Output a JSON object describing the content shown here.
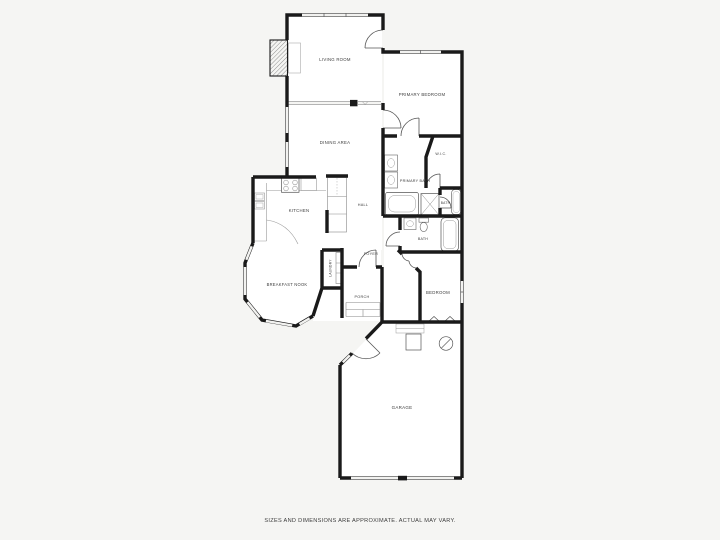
{
  "page": {
    "background_color": "#f5f5f3",
    "disclaimer": "SIZES AND DIMENSIONS ARE APPROXIMATE. ACTUAL MAY VARY."
  },
  "floorplan": {
    "wall_color": "#1a1a1a",
    "floor_color": "#ffffff",
    "label_color": "#3c3c3c",
    "rooms": {
      "living_room": {
        "label": "LIVING ROOM"
      },
      "primary_bedroom": {
        "label": "PRIMARY BEDROOM"
      },
      "dining_area": {
        "label": "DINING AREA"
      },
      "wic": {
        "label": "W.I.C."
      },
      "primary_bath": {
        "label": "PRIMARY BATH"
      },
      "kitchen": {
        "label": "KITCHEN"
      },
      "hall": {
        "label": "HALL"
      },
      "bath_upper": {
        "label": "BATH"
      },
      "bath_lower": {
        "label": "BATH"
      },
      "foyer": {
        "label": "FOYER"
      },
      "laundry": {
        "label": "LAUNDRY"
      },
      "breakfast_nook": {
        "label": "BREAKFAST NOOK"
      },
      "porch": {
        "label": "PORCH"
      },
      "bedroom": {
        "label": "BEDROOM"
      },
      "garage": {
        "label": "GARAGE"
      }
    }
  }
}
